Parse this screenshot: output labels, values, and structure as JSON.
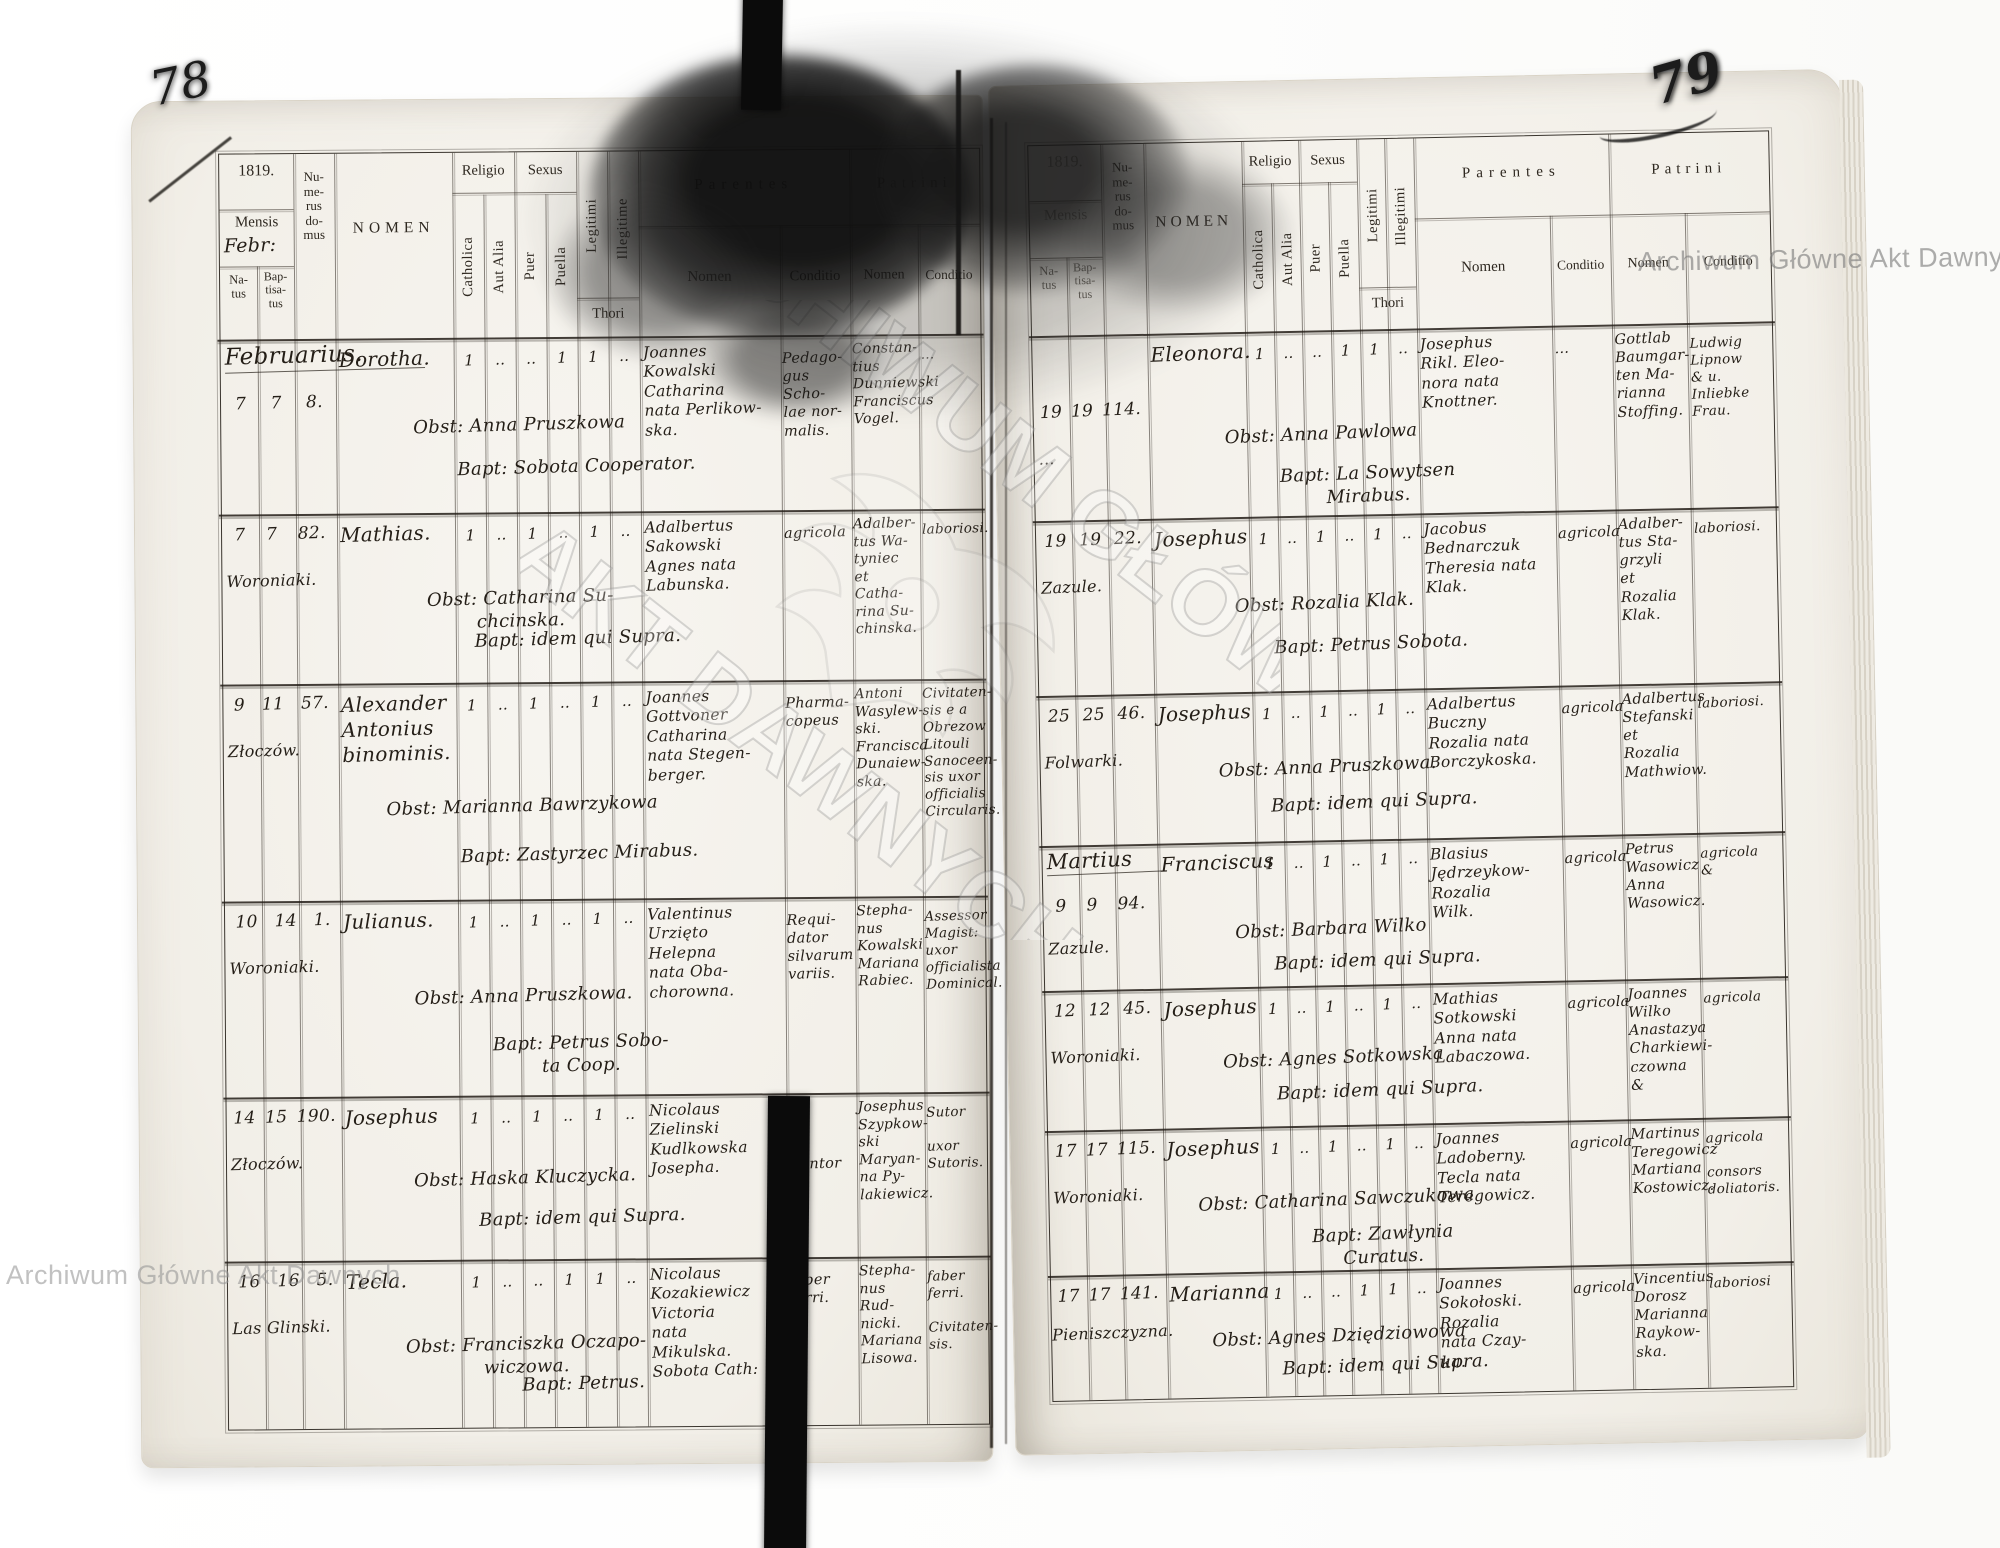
{
  "scan": {
    "archive_watermark": "Archiwum Główne Akt Dawnych",
    "archive_watermark_large_1": "ARCHIWUM GŁÓWNE",
    "archive_watermark_large_2": "AKT DAWNYCH",
    "left_page_number": "78",
    "right_page_number": "79"
  },
  "headers": {
    "year": "1819.",
    "mensis": "Mensis",
    "mensis_hand": "Febr:",
    "natus": "Na-\ntus",
    "baptisatus": "Bap-\ntisa-\ntus",
    "domus": "Nu-\nme-\nrus\ndo-\nmus",
    "nomen": "NOMEN",
    "religio": "Religio",
    "catholica": "Catholica",
    "aut_alia": "Aut Alia",
    "sexus": "Sexus",
    "puer": "Puer",
    "puella": "Puella",
    "legitimi": "Legitimi",
    "illegitime": "Illegitime",
    "illegitimi": "Illegitimi",
    "thori": "Thori",
    "parentes": "Parentes",
    "sub_nomen": "Nomen",
    "conditio": "Conditio",
    "patrini": "Patrini"
  },
  "left_page": {
    "month_header": "Februarius.",
    "rows": [
      {
        "natus": "7",
        "baptisatus": "7",
        "domus": "8.",
        "place": "",
        "name": "Dorotha.",
        "marks": [
          "1",
          "‥",
          "‥",
          "1",
          "1",
          "‥"
        ],
        "obst": "Obst: Anna Pruszkowa",
        "bapt": "Bapt: Sobota Cooperator.",
        "parentes": "Joannes\nKowalski\nCatharina\nnata Perlikow-\nska.",
        "parentes_conditio": "Pedago-\ngus Scho-\nlae nor-\nmalis.",
        "patrini": "Constan-\ntius\nDunniewski\nFranciscus\nVogel.",
        "patrini_conditio": "…"
      },
      {
        "natus": "7",
        "baptisatus": "7",
        "domus": "82.",
        "place": "Woroniaki.",
        "name": "Mathias.",
        "marks": [
          "1",
          "‥",
          "1",
          "‥",
          "1",
          "‥"
        ],
        "obst": "Obst: Catharina Su-\nchcinska.",
        "bapt": "Bapt: idem qui Supra.",
        "parentes": "Adalbertus\nSakowski\nAgnes nata\nLabunska.",
        "parentes_conditio": "agricola",
        "patrini": "Adalber-\ntus Wa-\ntyniec\net Catha-\nrina Su-\nchinska.",
        "patrini_conditio": "laboriosi."
      },
      {
        "natus": "9",
        "baptisatus": "11",
        "domus": "57.",
        "place": "Złoczów.",
        "name": "Alexander\nAntonius\nbinominis.",
        "marks": [
          "1",
          "‥",
          "1",
          "‥",
          "1",
          "‥"
        ],
        "obst": "Obst: Marianna Bawrzykowa",
        "bapt": "Bapt: Zastyrzec Mirabus.",
        "parentes": "Joannes\nGottvoner\nCatharina\nnata Stegen-\nberger.",
        "parentes_conditio": "Pharma-\ncopeus",
        "patrini": "Antoni\nWasylew-\nski.\nFrancisca\nDunaiew-\nska.",
        "patrini_conditio": "Civitaten-\nsis e a\nObrezow\nLitouli\nSanoceen-\nsis uxor\nofficialis\nCircularis."
      },
      {
        "natus": "10",
        "baptisatus": "14",
        "domus": "1.",
        "place": "Woroniaki.",
        "name": "Julianus.",
        "marks": [
          "1",
          "‥",
          "1",
          "‥",
          "1",
          "‥"
        ],
        "obst": "Obst: Anna Pruszkowa.",
        "bapt": "Bapt: Petrus Sobo-\nta Coop.",
        "parentes": "Valentinus\nUrzięto\nHelepna\nnata Oba-\nchorowna.",
        "parentes_conditio": "Requi-\ndator\nsilvarum\nvariis.",
        "patrini": "Stepha-\nnus\nKowalski\nMariana\nRabiec.",
        "patrini_conditio": "Assessor\nMagist:\nuxor\nofficialista\nDominical."
      },
      {
        "natus": "14",
        "baptisatus": "15",
        "domus": "190.",
        "place": "Złoczów.",
        "name": "Josephus",
        "marks": [
          "1",
          "‥",
          "1",
          "‥",
          "1",
          "‥"
        ],
        "obst": "Obst: Haska Kluczycka.",
        "bapt": "Bapt: idem qui Supra.",
        "parentes": "Nicolaus\nZielinski\nKudlkowska\nJosepha.",
        "parentes_conditio": "Cantor",
        "patrini": "Josephus\nSzypkow-\nski\nMaryan-\nna Py-\nlakiewicz.",
        "patrini_conditio": "Sutor\n\nuxor\nSutoris."
      },
      {
        "natus": "16",
        "baptisatus": "16",
        "domus": "5.",
        "place": "Las Glinski.",
        "name": "Tecla.",
        "marks": [
          "1",
          "‥",
          "‥",
          "1",
          "1",
          "‥"
        ],
        "obst": "Obst: Franciszka Oczapo-\nwiczowa.",
        "bapt": "Bapt: Petrus.",
        "parentes": "Nicolaus\nKozakiewicz\nVictoria\nnata\nMikulska.\nSobota Cath:",
        "parentes_conditio": "faber\nferri.",
        "patrini": "Stepha-\nnus Rud-\nnicki.\nMariana\nLisowa.",
        "patrini_conditio": "faber\nferri.\n\nCivitaten-\nsis."
      }
    ]
  },
  "right_page": {
    "month_header": "Martius",
    "rows": [
      {
        "natus": "19",
        "baptisatus": "19",
        "domus": "114.",
        "place": "…",
        "name": "Eleonora.",
        "marks": [
          "1",
          "‥",
          "‥",
          "1",
          "1",
          "‥"
        ],
        "obst": "Obst: Anna Pawlowa",
        "bapt": "Bapt: La Sowytsen\nMirabus.",
        "parentes": "Josephus\nRikl. Eleo-\nnora nata\nKnottner.",
        "parentes_conditio": "…",
        "patrini": "Gottlab\nBaumgar-\nten Ma-\nrianna\nStoffing.",
        "patrini_conditio": "Ludwig\nLipnow\n& u.\nInliebke\nFrau."
      },
      {
        "natus": "19",
        "baptisatus": "19",
        "domus": "22.",
        "place": "Zazule.",
        "name": "Josephus",
        "marks": [
          "1",
          "‥",
          "1",
          "‥",
          "1",
          "‥"
        ],
        "obst": "Obst: Rozalia Klak.",
        "bapt": "Bapt: Petrus Sobota.",
        "parentes": "Jacobus\nBednarczuk\nTheresia nata\nKlak.",
        "parentes_conditio": "agricola",
        "patrini": "Adalber-\ntus Sta-\ngrzyli\net Rozalia\nKlak.",
        "patrini_conditio": "laboriosi."
      },
      {
        "natus": "25",
        "baptisatus": "25",
        "domus": "46.",
        "place": "Folwarki.",
        "name": "Josephus",
        "marks": [
          "1",
          "‥",
          "1",
          "‥",
          "1",
          "‥"
        ],
        "obst": "Obst: Anna Pruszkowa.",
        "bapt": "Bapt: idem qui Supra.",
        "parentes": "Adalbertus\nBuczny\nRozalia nata\nBorczykoska.",
        "parentes_conditio": "agricola",
        "patrini": "Adalbertus\nStefanski\net\nRozalia\nMathwiow.",
        "patrini_conditio": "laboriosi."
      },
      {
        "natus": "9",
        "baptisatus": "9",
        "domus": "94.",
        "place": "Zazule.",
        "name": "Franciscus",
        "marks": [
          "1",
          "‥",
          "1",
          "‥",
          "1",
          "‥"
        ],
        "obst": "Obst: Barbara Wilko",
        "bapt": "Bapt: idem qui Supra.",
        "parentes": "Blasius\nJędrzeykow-\nRozalia\nWilk.",
        "parentes_conditio": "agricola",
        "patrini": "Petrus\nWasowicz\nAnna\nWasowicz.",
        "patrini_conditio": "agricola\n&"
      },
      {
        "natus": "12",
        "baptisatus": "12",
        "domus": "45.",
        "place": "Woroniaki.",
        "name": "Josephus",
        "marks": [
          "1",
          "‥",
          "1",
          "‥",
          "1",
          "‥"
        ],
        "obst": "Obst: Agnes Sotkowska",
        "bapt": "Bapt: idem qui Supra.",
        "parentes": "Mathias\nSotkowski\nAnna nata\nLabaczowa.",
        "parentes_conditio": "agricola",
        "patrini": "Joannes\nWilko\nAnastazya\nCharkiewi-\nczowna &",
        "patrini_conditio": "agricola"
      },
      {
        "natus": "17",
        "baptisatus": "17",
        "domus": "115.",
        "place": "Woroniaki.",
        "name": "Josephus",
        "marks": [
          "1",
          "‥",
          "1",
          "‥",
          "1",
          "‥"
        ],
        "obst": "Obst: Catharina Sawczukowa",
        "bapt": "Bapt: Zawłynia\nCuratus.",
        "parentes": "Joannes\nLadoberny.\nTecla nata\nTeregowicz.",
        "parentes_conditio": "agricola",
        "patrini": "Martinus\nTeregowicz\nMartiana\nKostowicz.",
        "patrini_conditio": "agricola\n\nconsors\ndoliatoris."
      },
      {
        "natus": "17",
        "baptisatus": "17",
        "domus": "141.",
        "place": "Pieniszczyzna.",
        "name": "Marianna",
        "marks": [
          "1",
          "‥",
          "‥",
          "1",
          "1",
          "‥"
        ],
        "obst": "Obst: Agnes Dziędziowowa",
        "bapt": "Bapt: idem qui Supra.",
        "parentes": "Joannes\nSokołoski.\nRozalia\nnata Czay-\nka.",
        "parentes_conditio": "agricola",
        "patrini": "Vincentius\nDorosz\nMarianna\nRaykow-\nska.",
        "patrini_conditio": "laboriosi"
      }
    ]
  }
}
